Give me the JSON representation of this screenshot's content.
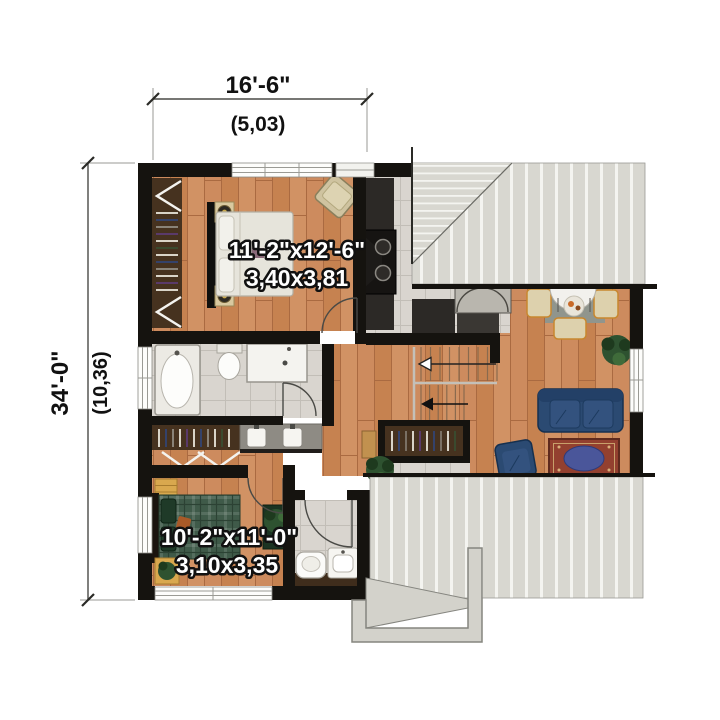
{
  "annotations": {
    "width_ft": "16'-6\"",
    "width_m": "(5,03)",
    "height_ft": "34'-0\"",
    "height_m": "(10,36)"
  },
  "rooms": {
    "master_bedroom": {
      "dims_ft": "11'-2\"x12'-6\"",
      "dims_m": "3,40x3,81"
    },
    "bedroom_2": {
      "dims_ft": "10'-2\"x11'-0\"",
      "dims_m": "3,10x3,35"
    }
  },
  "colors": {
    "wall": "#15130f",
    "wood_base": "#cd8b5e",
    "wood_mid": "#c68250",
    "wood_light": "#d19264",
    "wood_line": "#aa6a41",
    "tile": "#d9d5cf",
    "tile_line": "#c2beb7",
    "roof": "#d8d7d0",
    "roof_stripe": "#f4f4f0",
    "roof_edge": "#97968f",
    "counter_dark": "#2c2926",
    "closet_wood": "#46321f",
    "vanity_gray": "#8e8b84",
    "sofa_blue": "#2b4a72",
    "cushion_blue": "#33527e",
    "rug_red": "#93402f",
    "rug_blue": "#4a569a",
    "bed_white": "#e6e4db",
    "bed_green": "#3f5a49",
    "plaid_dark": "#2c4234",
    "chair_cream": "#ddd1ad",
    "chair_trim": "#c8872e",
    "plant_green": "#2e5230",
    "plant_dark": "#1e3a1e",
    "accent_tan": "#d9c9a0",
    "dresser_yellow": "#d9a84e",
    "dim_text": "#111111",
    "label_text": "#ffffff",
    "label_outline": "#111111"
  }
}
